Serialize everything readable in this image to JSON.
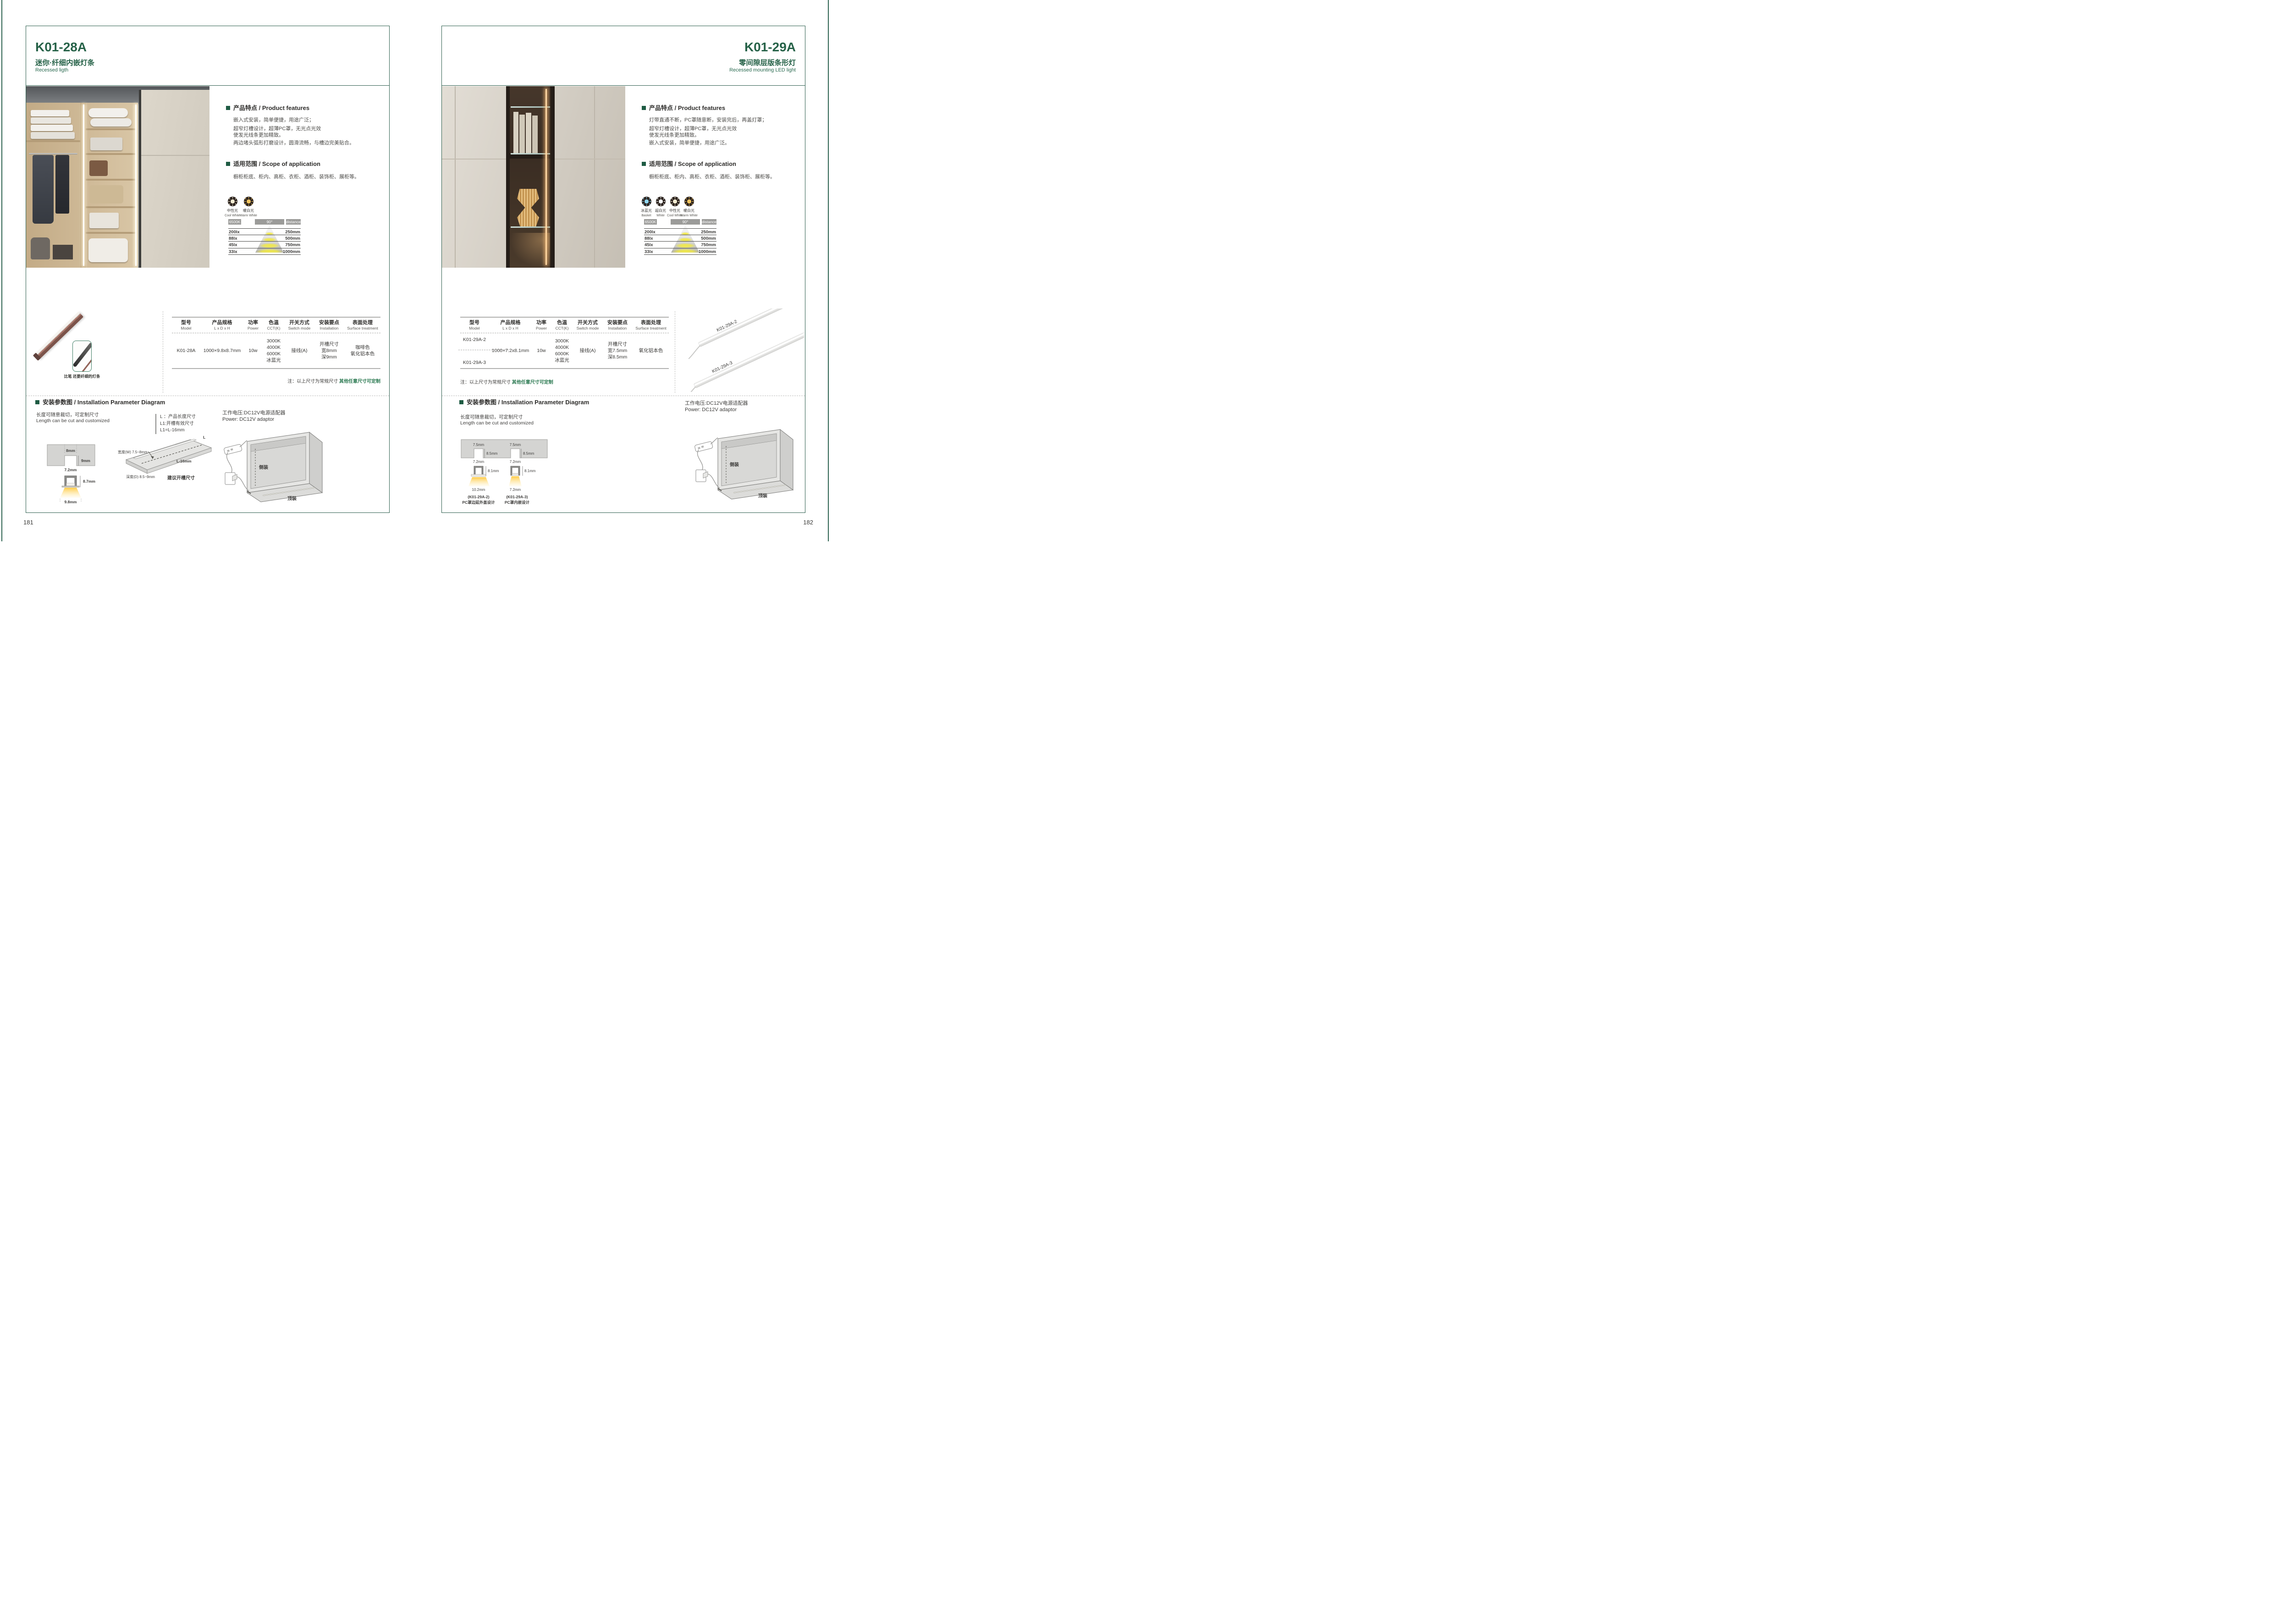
{
  "page_left": {
    "page_no": "181",
    "model": "K01-28A",
    "subtitle_cn": "迷你·纤细内嵌灯条",
    "subtitle_en": "Recessed ligth",
    "features_title": "产品特点 / Product features",
    "features": [
      "嵌入式安装，简单便捷，用途广泛；",
      "超窄灯槽设计，超薄PC罩，无光点光效",
      "使发光线条更加精致。",
      "两边堵头弧形打磨设计，圆滑流畅，与槽边完美贴合。"
    ],
    "scope_title": "适用范围 / Scope of application",
    "scope_text": "橱柜柜底、柜内、高柜、衣柜、酒柜、装饰柜、展柜等。",
    "light_icons": [
      {
        "cn": "中性光",
        "en": "Cool White",
        "color": "#f6ecd2"
      },
      {
        "cn": "暖白光",
        "en": "Warm White",
        "color": "#f0c35e"
      }
    ],
    "chart": {
      "cct": "6500K",
      "angle": "90°",
      "distance": "distance",
      "rows": [
        {
          "lx": "200lx",
          "mm": "250mm"
        },
        {
          "lx": "88lx",
          "mm": "500mm"
        },
        {
          "lx": "45lx",
          "mm": "750mm"
        },
        {
          "lx": "33lx",
          "mm": "1000mm"
        }
      ]
    },
    "table": {
      "headers": [
        {
          "cn": "型号",
          "en": "Model"
        },
        {
          "cn": "产品规格",
          "en": "L x D x H"
        },
        {
          "cn": "功率",
          "en": "Power"
        },
        {
          "cn": "色温",
          "en": "CCT(K)"
        },
        {
          "cn": "开关方式",
          "en": "Switch mode"
        },
        {
          "cn": "安装要点",
          "en": "Installation"
        },
        {
          "cn": "表面处理",
          "en": "Surface treatment"
        }
      ],
      "model": "K01-28A",
      "spec": "1000×9.8x8.7mm",
      "power": "10w",
      "cct": [
        "3000K",
        "4000K",
        "6000K",
        "冰蓝光"
      ],
      "switch": "接线(A)",
      "install": [
        "开槽尺寸",
        "宽8mm",
        "深9mm"
      ],
      "surface": [
        "咖啡色",
        "氧化铝本色"
      ]
    },
    "note_label": "注：以上尺寸为常规尺寸",
    "note_green": "其他任意尺寸可定制",
    "photo_caption": "比笔 还要纤细的灯条",
    "install_title": "安装参数图 / Installation Parameter Diagram",
    "length_cn": "长度可随意裁切，可定制尺寸",
    "length_en": "Length can be cut and customized",
    "legend": [
      "L ：产品长度尺寸",
      "L1:开槽有效尺寸",
      "L1=L-16mm"
    ],
    "cross": {
      "top": "8mm",
      "depth": "9mm",
      "width": "7.2mm",
      "height": "8.7mm",
      "bottom": "9.8mm"
    },
    "board": {
      "len": "L",
      "width": "宽度(W) 7.5~8mm",
      "l16": "L-16mm",
      "depth": "深度(D) 8.5~9mm",
      "caption": "建议开槽尺寸"
    },
    "power_cn": "工作电压:DC12V电源适配器",
    "power_en": "Power: DC12V adaptor",
    "cabinet": {
      "side": "侧装",
      "top": "顶装"
    }
  },
  "page_right": {
    "page_no": "182",
    "model": "K01-29A",
    "subtitle_cn": "零间隙层版条形灯",
    "subtitle_en": "Recessed mounting LED light",
    "features_title": "产品特点 / Product features",
    "features": [
      "灯带直通不断，PC罩随意断，安装完后，再盖灯罩；",
      "超窄灯槽设计，超薄PC罩，无光点光效",
      "使发光线条更加精致。",
      "嵌入式安装，简单便捷，用途广泛。"
    ],
    "scope_title": "适用范围 / Scope of application",
    "scope_text": "橱柜柜底、柜内、高柜、衣柜、酒柜、装饰柜、展柜等。",
    "light_icons": [
      {
        "cn": "冰蓝光",
        "en": "Basket",
        "color": "#8fd6f2"
      },
      {
        "cn": "超白光",
        "en": "White",
        "color": "#ffffff"
      },
      {
        "cn": "中性光",
        "en": "Cool White",
        "color": "#f6ecd2"
      },
      {
        "cn": "暖白光",
        "en": "Warm White",
        "color": "#f0c35e"
      }
    ],
    "chart": {
      "cct": "6500K",
      "angle": "90°",
      "distance": "distance",
      "rows": [
        {
          "lx": "200lx",
          "mm": "250mm"
        },
        {
          "lx": "88lx",
          "mm": "500mm"
        },
        {
          "lx": "45lx",
          "mm": "750mm"
        },
        {
          "lx": "33lx",
          "mm": "1000mm"
        }
      ]
    },
    "table": {
      "headers": [
        {
          "cn": "型号",
          "en": "Model"
        },
        {
          "cn": "产品规格",
          "en": "L x D x H"
        },
        {
          "cn": "功率",
          "en": "Power"
        },
        {
          "cn": "色温",
          "en": "CCT(K)"
        },
        {
          "cn": "开关方式",
          "en": "Switch mode"
        },
        {
          "cn": "安装要点",
          "en": "Installation"
        },
        {
          "cn": "表面处理",
          "en": "Surface treatment"
        }
      ],
      "models": [
        "K01-29A-2",
        "K01-29A-3"
      ],
      "spec": "1000×7.2x8.1mm",
      "power": "10w",
      "cct": [
        "3000K",
        "4000K",
        "6000K",
        "冰蓝光"
      ],
      "switch": "接线(A)",
      "install": [
        "开槽尺寸",
        "宽7.5mm",
        "深8.5mm"
      ],
      "surface": [
        "氧化铝本色"
      ]
    },
    "note_label": "注：以上尺寸为常规尺寸",
    "note_green": "其他任意尺寸可定制",
    "strip_labels": [
      "K01-29A-2",
      "K01-29A-3"
    ],
    "install_title": "安装参数图 / Installation Parameter Diagram",
    "length_cn": "长度可随意裁切，可定制尺寸",
    "length_en": "Length can be cut and customized",
    "cross": {
      "top": "7.5mm",
      "depth": "8.5mm",
      "width": "7.2mm",
      "height": "8.1mm",
      "bottoms": [
        "10.2mm",
        "7.2mm"
      ],
      "captions": [
        [
          "(K01-29A-2)",
          "PC罩边延外盖设计"
        ],
        [
          "(K01-29A-3)",
          "PC罩内嵌设计"
        ]
      ]
    },
    "power_cn": "工作电压:DC12V电源适配器",
    "power_en": "Power: DC12V adaptor",
    "cabinet": {
      "side": "侧装",
      "top": "顶装"
    }
  }
}
